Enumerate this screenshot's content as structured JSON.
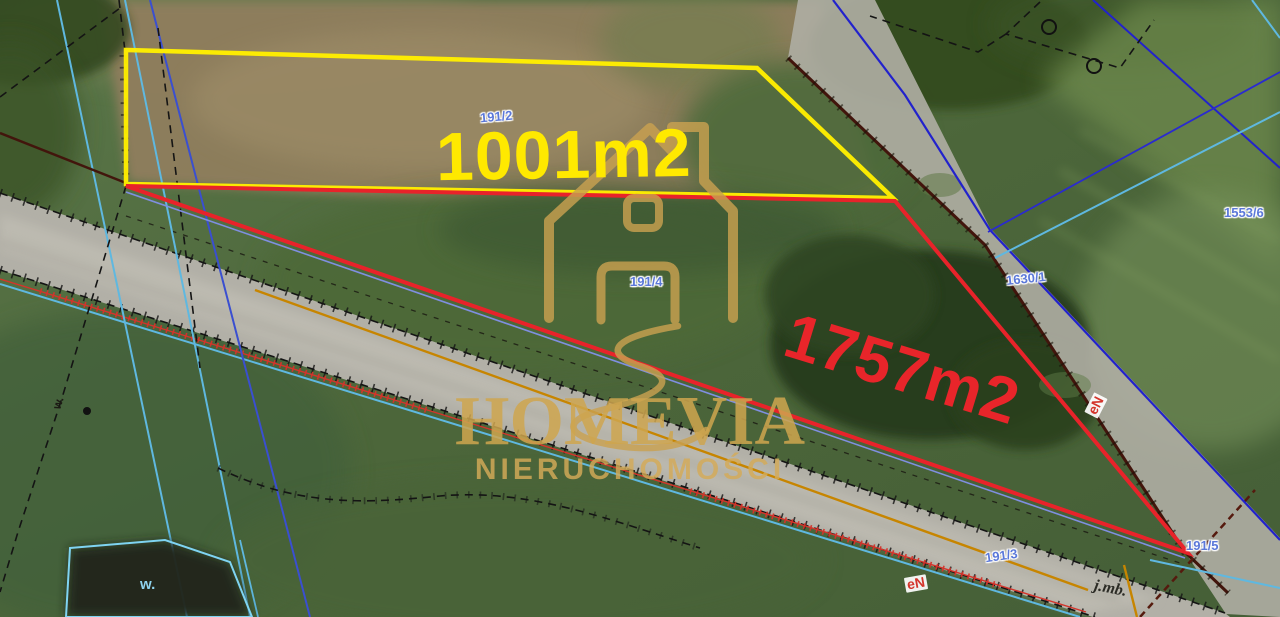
{
  "brand": {
    "name": "HOMEVIA",
    "tagline": "NIERUCHOMOŚCI"
  },
  "parcels": {
    "a": {
      "area": "1001m2",
      "number": "191/2"
    },
    "b": {
      "area": "1757m2",
      "number": "191/4"
    }
  },
  "adjacent_parcels": {
    "road": "1630/1",
    "northeast": "1553/6",
    "south": "191/3",
    "southeast": "191/5"
  },
  "annotations": {
    "utility_line_1": "eN",
    "utility_line_2": "eN",
    "unit": "j.mb.",
    "water_1": "w.",
    "water_2": "w."
  },
  "colors": {
    "parcel_a_outline": "#ffee00",
    "parcel_b_outline": "#e8232a",
    "area_label_a": "#ffe900",
    "area_label_b": "#e8252a",
    "watermark_gold": "#cfa64f",
    "cadastral_blue": "#2222cc",
    "cadastral_cyan": "#5fb8e0",
    "parcel_number_blue": "#5b78d9",
    "utility_red": "#d4342b",
    "boundary_maroon": "#42150c",
    "boundary_orange": "#c78500"
  }
}
